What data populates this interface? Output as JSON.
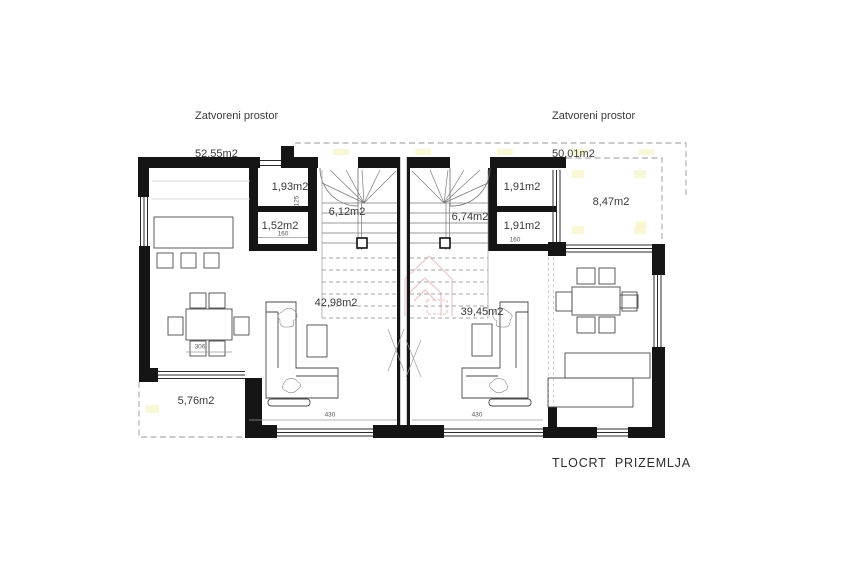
{
  "plan": {
    "header_left": {
      "label": "Zatvoreni prostor",
      "area": "52,55m2"
    },
    "header_right": {
      "label": "Zatvoreni prostor",
      "area": "50,01m2"
    },
    "title": "TLOCRT  PRIZEMLJA",
    "rooms": {
      "left_wc": "1,93m2",
      "left_storage": "1,52m2",
      "left_hall": "6,12m2",
      "left_living": "42,98m2",
      "left_terrace": "5,76m2",
      "right_wc": "1,91m2",
      "right_storage": "1,91m2",
      "right_hall": "6,74m2",
      "right_living": "39,45m2",
      "right_terrace": "8,47m2"
    },
    "dimensions": {
      "left_window": "430",
      "right_window": "430",
      "left_table": "306",
      "left_storage_width": "160",
      "right_storage_width": "160",
      "left_wc_height": "125"
    }
  },
  "colors": {
    "wall": "#151515",
    "text": "#3a3a3a",
    "dashed": "#9a9a9a",
    "watermark": "#dc8f99",
    "highlight": "#f5f0b4"
  }
}
